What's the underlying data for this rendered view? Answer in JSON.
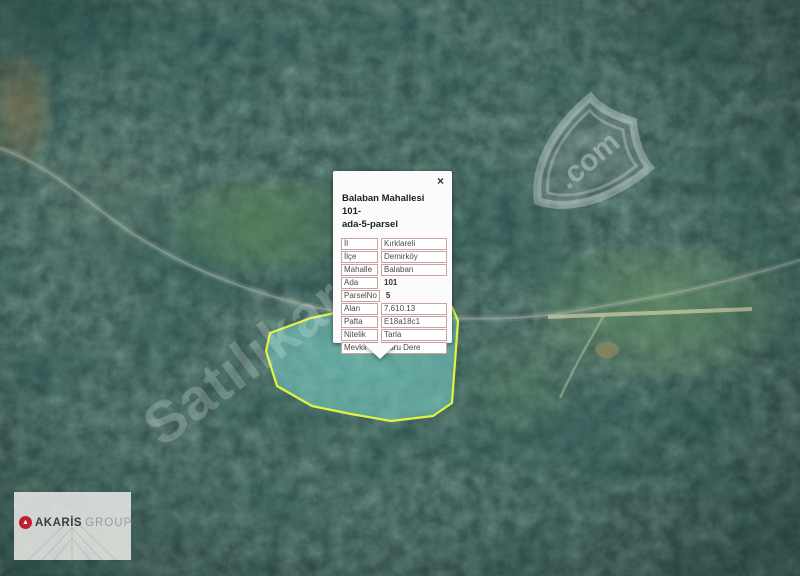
{
  "map": {
    "parcel": {
      "stroke_color": "#e3f241",
      "fill_color": "rgba(121,214,203,0.5)"
    }
  },
  "popup": {
    "title": "Balaban Mahallesi 101-ada-5-parsel",
    "title_lines": [
      "Balaban Mahallesi 101-",
      "ada-5-parsel"
    ],
    "close_label": "×",
    "fields": [
      {
        "label": "İl",
        "value": "Kırklareli",
        "boxed": true
      },
      {
        "label": "İlçe",
        "value": "Demirköy",
        "boxed": true
      },
      {
        "label": "Mahalle",
        "value": "Balaban",
        "boxed": true
      },
      {
        "label": "Ada",
        "value": "101",
        "boxed": false
      },
      {
        "label": "ParselNo",
        "value": "5",
        "boxed": false
      },
      {
        "label": "Alan",
        "value": "7,610.13",
        "boxed": true
      },
      {
        "label": "Pafta",
        "value": "E18a18c1",
        "boxed": true
      },
      {
        "label": "Nitelik",
        "value": "Tarla",
        "boxed": true
      },
      {
        "label": "Mevkii",
        "value": "Kuru Dere",
        "boxed": true
      }
    ]
  },
  "watermark": {
    "text": "Satılıkarandı",
    "badge_text": ".com"
  },
  "logo": {
    "icon_glyph": "▲",
    "primary": "AKARİS",
    "secondary": "GROUP"
  }
}
